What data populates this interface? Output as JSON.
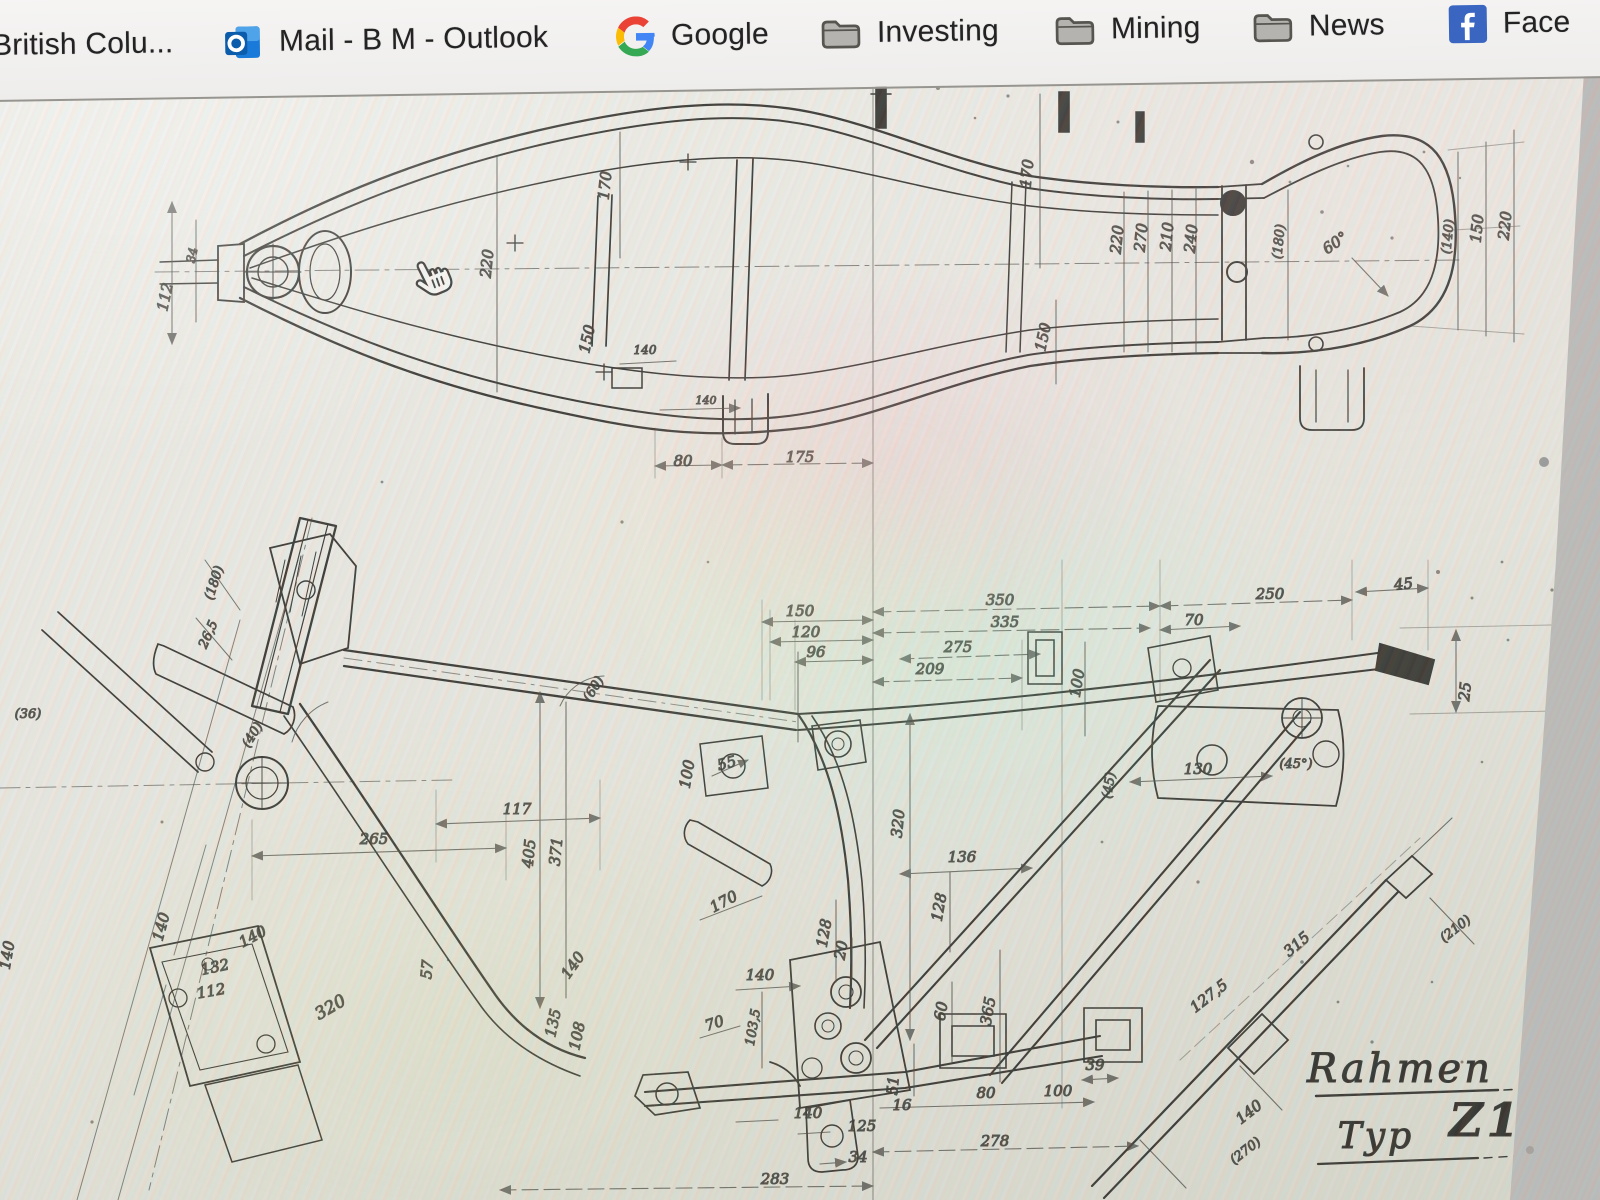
{
  "bookmarks_bar": {
    "items": [
      {
        "label": "British Colu...",
        "icon": "none"
      },
      {
        "label": "Mail - B M - Outlook",
        "icon": "outlook-icon"
      },
      {
        "label": "Google",
        "icon": "google-icon"
      },
      {
        "label": "Investing",
        "icon": "folder-icon"
      },
      {
        "label": "Mining",
        "icon": "folder-icon"
      },
      {
        "label": "News",
        "icon": "folder-icon"
      },
      {
        "label": "Face",
        "icon": "facebook-icon"
      }
    ]
  },
  "document": {
    "title": {
      "name": "Rahmen",
      "type_label": "Typ",
      "type_code": "Z1"
    },
    "cursor_icon": "pointer-hand",
    "views": {
      "top_view_labels": [
        {
          "t": "112",
          "x": 170,
          "y": 298,
          "r": -78
        },
        {
          "t": "34",
          "x": 196,
          "y": 256,
          "r": -78,
          "s": 12
        },
        {
          "t": "220",
          "x": 492,
          "y": 264,
          "r": -84
        },
        {
          "t": "170",
          "x": 610,
          "y": 186,
          "r": -84
        },
        {
          "t": "150",
          "x": 592,
          "y": 340,
          "r": -78
        },
        {
          "t": "140",
          "x": 645,
          "y": 354,
          "s": 12
        },
        {
          "t": "140",
          "x": 706,
          "y": 404,
          "s": 11
        },
        {
          "t": "80",
          "x": 683,
          "y": 466
        },
        {
          "t": "175",
          "x": 800,
          "y": 462
        },
        {
          "t": "170",
          "x": 1032,
          "y": 174,
          "r": -84
        },
        {
          "t": "150",
          "x": 1048,
          "y": 338,
          "r": -78
        },
        {
          "t": "220",
          "x": 1122,
          "y": 240,
          "r": -84
        },
        {
          "t": "270",
          "x": 1146,
          "y": 238,
          "r": -84
        },
        {
          "t": "210",
          "x": 1172,
          "y": 237,
          "r": -84
        },
        {
          "t": "240",
          "x": 1196,
          "y": 239,
          "r": -84
        },
        {
          "t": "(180)",
          "x": 1283,
          "y": 242,
          "r": -84,
          "s": 13
        },
        {
          "t": "60°",
          "x": 1338,
          "y": 247,
          "r": -35
        },
        {
          "t": "(140)",
          "x": 1452,
          "y": 237,
          "r": -84,
          "s": 13
        },
        {
          "t": "150",
          "x": 1482,
          "y": 229,
          "r": -84
        },
        {
          "t": "220",
          "x": 1510,
          "y": 226,
          "r": -84
        }
      ],
      "side_view_labels": [
        {
          "t": "(180)",
          "x": 218,
          "y": 584,
          "r": -72,
          "s": 13
        },
        {
          "t": "26,5",
          "x": 212,
          "y": 636,
          "r": -66,
          "s": 13
        },
        {
          "t": "(36)",
          "x": 28,
          "y": 718,
          "s": 13
        },
        {
          "t": "(40)",
          "x": 256,
          "y": 737,
          "r": -58,
          "s": 13
        },
        {
          "t": "(60)",
          "x": 597,
          "y": 691,
          "r": -58,
          "s": 13
        },
        {
          "t": "150",
          "x": 800,
          "y": 616
        },
        {
          "t": "120",
          "x": 806,
          "y": 637
        },
        {
          "t": "96",
          "x": 816,
          "y": 657
        },
        {
          "t": "209",
          "x": 930,
          "y": 674
        },
        {
          "t": "350",
          "x": 1000,
          "y": 605
        },
        {
          "t": "335",
          "x": 1005,
          "y": 627
        },
        {
          "t": "275",
          "x": 958,
          "y": 652
        },
        {
          "t": "70",
          "x": 1194,
          "y": 625
        },
        {
          "t": "250",
          "x": 1270,
          "y": 599
        },
        {
          "t": "45",
          "x": 1404,
          "y": 589,
          "r": -6
        },
        {
          "t": "25",
          "x": 1470,
          "y": 692,
          "r": -84
        },
        {
          "t": "100",
          "x": 692,
          "y": 775,
          "r": -80
        },
        {
          "t": "100",
          "x": 1082,
          "y": 684,
          "r": -80
        },
        {
          "t": "130",
          "x": 1198,
          "y": 774
        },
        {
          "t": "(45°)",
          "x": 1296,
          "y": 768,
          "s": 13
        },
        {
          "t": "(45)",
          "x": 1113,
          "y": 786,
          "r": -80,
          "s": 13
        },
        {
          "t": "117",
          "x": 517,
          "y": 814
        },
        {
          "t": "265",
          "x": 374,
          "y": 844
        },
        {
          "t": "405",
          "x": 534,
          "y": 854,
          "r": -84
        },
        {
          "t": "371",
          "x": 561,
          "y": 852,
          "r": -84
        },
        {
          "t": "320",
          "x": 903,
          "y": 824,
          "r": -84
        },
        {
          "t": "55",
          "x": 728,
          "y": 768,
          "r": -15
        },
        {
          "t": "170",
          "x": 726,
          "y": 906,
          "r": -28
        },
        {
          "t": "140",
          "x": 12,
          "y": 956,
          "r": -80
        },
        {
          "t": "140",
          "x": 166,
          "y": 928,
          "r": -75
        },
        {
          "t": "140",
          "x": 255,
          "y": 941,
          "r": -28
        },
        {
          "t": "132",
          "x": 216,
          "y": 972,
          "r": -12
        },
        {
          "t": "112",
          "x": 212,
          "y": 996,
          "r": -10
        },
        {
          "t": "320",
          "x": 333,
          "y": 1012,
          "r": -30,
          "s": 17
        },
        {
          "t": "57",
          "x": 432,
          "y": 970,
          "r": -85
        },
        {
          "t": "140",
          "x": 577,
          "y": 968,
          "r": -55
        },
        {
          "t": "135",
          "x": 558,
          "y": 1024,
          "r": -78
        },
        {
          "t": "108",
          "x": 582,
          "y": 1037,
          "r": -78
        },
        {
          "t": "70",
          "x": 716,
          "y": 1028,
          "r": -18
        },
        {
          "t": "103,5",
          "x": 757,
          "y": 1028,
          "r": -80,
          "s": 13
        },
        {
          "t": "140",
          "x": 760,
          "y": 980
        },
        {
          "t": "128",
          "x": 829,
          "y": 934,
          "r": -80
        },
        {
          "t": "20",
          "x": 846,
          "y": 951,
          "r": -80
        },
        {
          "t": "128",
          "x": 944,
          "y": 908,
          "r": -80
        },
        {
          "t": "136",
          "x": 962,
          "y": 862
        },
        {
          "t": "365",
          "x": 993,
          "y": 1012,
          "r": -80
        },
        {
          "t": "60",
          "x": 946,
          "y": 1012,
          "r": -80
        },
        {
          "t": "51",
          "x": 898,
          "y": 1086,
          "r": -85
        },
        {
          "t": "16",
          "x": 902,
          "y": 1110
        },
        {
          "t": "80",
          "x": 986,
          "y": 1098
        },
        {
          "t": "100",
          "x": 1058,
          "y": 1096
        },
        {
          "t": "39",
          "x": 1095,
          "y": 1070
        },
        {
          "t": "278",
          "x": 995,
          "y": 1146
        },
        {
          "t": "283",
          "x": 775,
          "y": 1184
        },
        {
          "t": "140",
          "x": 808,
          "y": 1118
        },
        {
          "t": "125",
          "x": 862,
          "y": 1131
        },
        {
          "t": "34",
          "x": 858,
          "y": 1162
        },
        {
          "t": "315",
          "x": 1300,
          "y": 948,
          "r": -40
        },
        {
          "t": "127,5",
          "x": 1212,
          "y": 1000,
          "r": -38
        },
        {
          "t": "(210)",
          "x": 1458,
          "y": 932,
          "r": -38,
          "s": 13
        },
        {
          "t": "140",
          "x": 1252,
          "y": 1116,
          "r": -38
        },
        {
          "t": "(270)",
          "x": 1248,
          "y": 1154,
          "r": -38,
          "s": 13
        }
      ]
    }
  },
  "colors": {
    "ink": "#26241f",
    "paper": "#e9e7e0",
    "bar_bg": "#f3f2f0",
    "facebook_blue": "#3a66c2",
    "outlook_blue": "#0b5cab"
  }
}
